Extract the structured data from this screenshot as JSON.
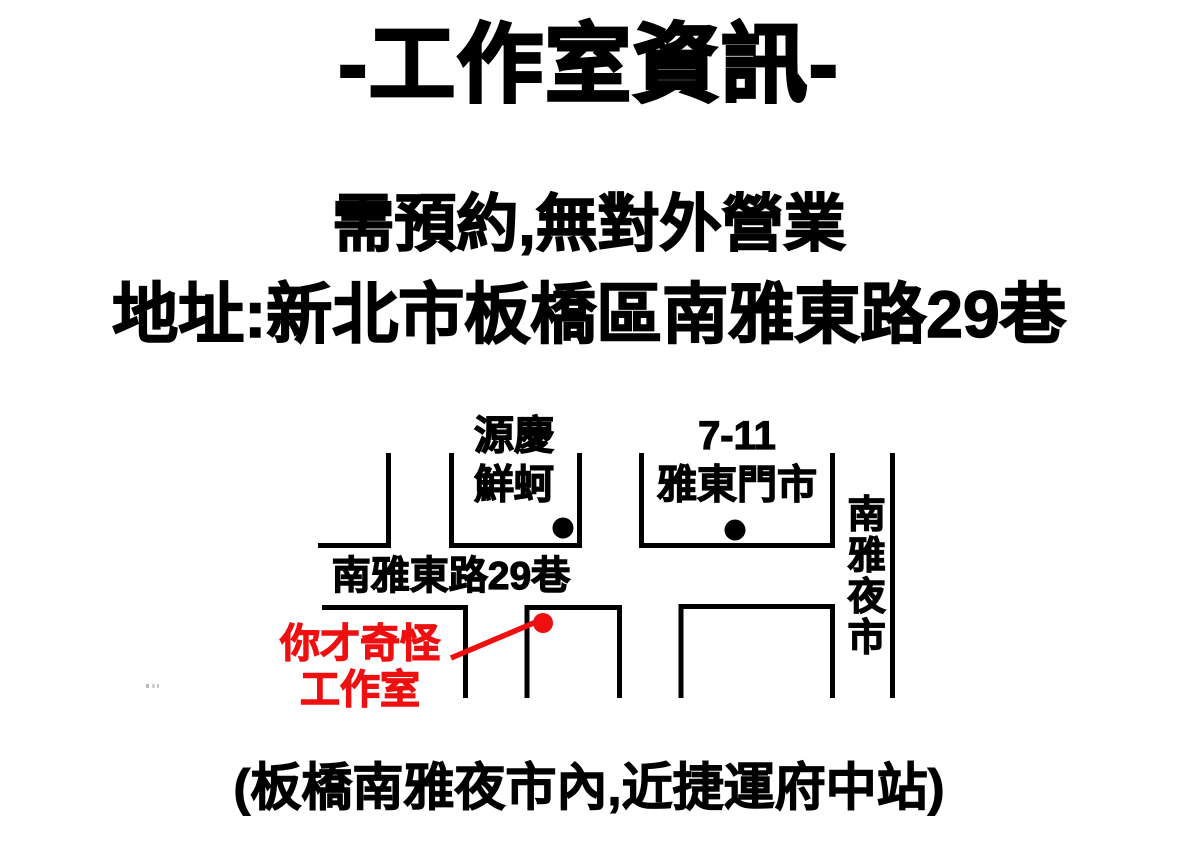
{
  "title": "-工作室資訊-",
  "info": {
    "line1": "需預約,無對外營業",
    "line2": "地址:新北市板橋區南雅東路29巷"
  },
  "map": {
    "store1": {
      "line1": "源慶",
      "line2": "鮮蚵"
    },
    "store2": {
      "line1": "7-11",
      "line2": "雅東門市"
    },
    "night_market": "南雅夜市",
    "street": "南雅東路29巷",
    "studio": {
      "line1": "你才奇怪",
      "line2": "工作室"
    },
    "markers": {
      "store1": "black-dot",
      "store2": "black-dot",
      "studio": "red-dot-with-pointer-line"
    }
  },
  "caption": "(板橋南雅夜市內,近捷運府中站)",
  "colors": {
    "ink": "#000000",
    "accent_red": "#ee1010",
    "background": "#ffffff"
  }
}
